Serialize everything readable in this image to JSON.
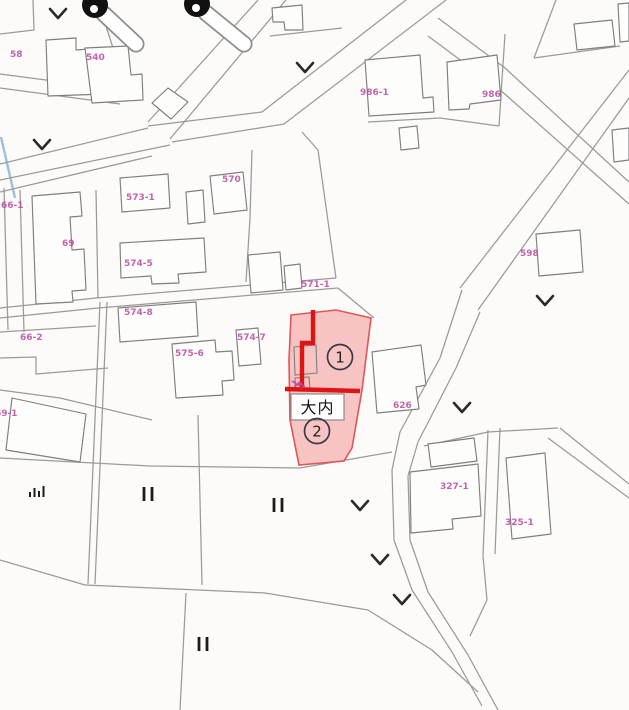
{
  "map": {
    "width": 629,
    "height": 710,
    "style": {
      "bg": "#fcfbf9",
      "road": "#9a9a9a",
      "building": "#7f7f7f",
      "building_fill": "#fdfdfc",
      "label_color": "#b94a9e",
      "symbol_color": "#2a2a2a",
      "water_line": "#8ab4d8"
    },
    "roads": [
      [
        [
          0,
          74
        ],
        [
          122,
          90
        ]
      ],
      [
        [
          0,
          88
        ],
        [
          120,
          104
        ]
      ],
      [
        [
          122,
          90
        ],
        [
          113,
          48
        ],
        [
          106,
          26
        ]
      ],
      [
        [
          258,
          0
        ],
        [
          148,
          122
        ]
      ],
      [
        [
          286,
          0
        ],
        [
          170,
          139
        ]
      ],
      [
        [
          148,
          128
        ],
        [
          0,
          164
        ]
      ],
      [
        [
          170,
          145
        ],
        [
          0,
          180
        ]
      ],
      [
        [
          0,
          192
        ],
        [
          152,
          156
        ]
      ],
      [
        [
          406,
          0
        ],
        [
          262,
          112
        ]
      ],
      [
        [
          446,
          0
        ],
        [
          284,
          124
        ]
      ],
      [
        [
          262,
          112
        ],
        [
          148,
          126
        ]
      ],
      [
        [
          284,
          124
        ],
        [
          172,
          142
        ]
      ],
      [
        [
          438,
          18
        ],
        [
          505,
          68
        ],
        [
          629,
          182
        ]
      ],
      [
        [
          428,
          36
        ],
        [
          498,
          88
        ],
        [
          629,
          204
        ]
      ],
      [
        [
          629,
          70
        ],
        [
          460,
          288
        ]
      ],
      [
        [
          629,
          98
        ],
        [
          478,
          310
        ]
      ],
      [
        [
          462,
          290
        ],
        [
          440,
          358
        ],
        [
          400,
          432
        ]
      ],
      [
        [
          480,
          312
        ],
        [
          456,
          368
        ],
        [
          418,
          442
        ]
      ],
      [
        [
          400,
          432
        ],
        [
          392,
          470
        ],
        [
          394,
          540
        ],
        [
          412,
          590
        ],
        [
          452,
          652
        ],
        [
          482,
          706
        ]
      ],
      [
        [
          418,
          442
        ],
        [
          408,
          476
        ],
        [
          410,
          540
        ],
        [
          428,
          592
        ],
        [
          468,
          655
        ],
        [
          498,
          710
        ]
      ],
      [
        [
          0,
          458
        ],
        [
          150,
          466
        ],
        [
          300,
          468
        ],
        [
          392,
          452
        ]
      ],
      [
        [
          424,
          446
        ],
        [
          488,
          432
        ],
        [
          558,
          428
        ]
      ],
      [
        [
          488,
          430
        ],
        [
          483,
          556
        ]
      ],
      [
        [
          500,
          428
        ],
        [
          495,
          554
        ]
      ],
      [
        [
          483,
          556
        ],
        [
          487,
          600
        ],
        [
          470,
          636
        ]
      ],
      [
        [
          548,
          438
        ],
        [
          629,
          498
        ]
      ],
      [
        [
          560,
          428
        ],
        [
          629,
          484
        ]
      ],
      [
        [
          85,
          585
        ],
        [
          265,
          593
        ],
        [
          368,
          610
        ],
        [
          432,
          650
        ],
        [
          478,
          692
        ]
      ],
      [
        [
          186,
          593
        ],
        [
          180,
          710
        ]
      ],
      [
        [
          0,
          560
        ],
        [
          85,
          585
        ]
      ],
      [
        [
          100,
          302
        ],
        [
          88,
          584
        ]
      ],
      [
        [
          107,
          302
        ],
        [
          95,
          584
        ]
      ],
      [
        [
          0,
          308
        ],
        [
          96,
          298
        ],
        [
          336,
          278
        ]
      ],
      [
        [
          0,
          318
        ],
        [
          98,
          308
        ],
        [
          338,
          288
        ]
      ],
      [
        [
          338,
          288
        ],
        [
          374,
          318
        ]
      ],
      [
        [
          336,
          278
        ],
        [
          318,
          150
        ],
        [
          302,
          132
        ]
      ],
      [
        [
          252,
          150
        ],
        [
          250,
          218
        ],
        [
          246,
          282
        ]
      ],
      [
        [
          4,
          188
        ],
        [
          8,
          330
        ]
      ],
      [
        [
          20,
          190
        ],
        [
          24,
          332
        ]
      ],
      [
        [
          96,
          190
        ],
        [
          98,
          298
        ]
      ],
      [
        [
          0,
          332
        ],
        [
          96,
          326
        ]
      ],
      [
        [
          0,
          358
        ],
        [
          36,
          357
        ],
        [
          36,
          374
        ],
        [
          108,
          368
        ]
      ],
      [
        [
          0,
          390
        ],
        [
          60,
          398
        ],
        [
          152,
          420
        ]
      ],
      [
        [
          505,
          34
        ],
        [
          499,
          126
        ]
      ],
      [
        [
          368,
          122
        ],
        [
          440,
          118
        ],
        [
          499,
          126
        ]
      ],
      [
        [
          556,
          0
        ],
        [
          534,
          58
        ]
      ],
      [
        [
          534,
          58
        ],
        [
          620,
          46
        ]
      ],
      [
        [
          270,
          36
        ],
        [
          342,
          28
        ]
      ],
      [
        [
          33,
          0
        ],
        [
          34,
          30
        ],
        [
          0,
          34
        ]
      ],
      [
        [
          198,
          415
        ],
        [
          202,
          585
        ]
      ]
    ],
    "buildings": [
      [
        [
          46,
          40
        ],
        [
          76,
          38
        ],
        [
          76,
          50
        ],
        [
          103,
          48
        ],
        [
          105,
          94
        ],
        [
          48,
          96
        ]
      ],
      [
        [
          85,
          48
        ],
        [
          128,
          46
        ],
        [
          131,
          75
        ],
        [
          142,
          74
        ],
        [
          143,
          100
        ],
        [
          92,
          103
        ]
      ],
      [
        [
          152,
          103
        ],
        [
          168,
          88
        ],
        [
          188,
          102
        ],
        [
          171,
          119
        ]
      ],
      [
        [
          365,
          60
        ],
        [
          420,
          55
        ],
        [
          423,
          98
        ],
        [
          433,
          97
        ],
        [
          434,
          112
        ],
        [
          369,
          116
        ]
      ],
      [
        [
          447,
          62
        ],
        [
          497,
          55
        ],
        [
          501,
          100
        ],
        [
          470,
          104
        ],
        [
          469,
          109
        ],
        [
          449,
          110
        ]
      ],
      [
        [
          399,
          128
        ],
        [
          417,
          126
        ],
        [
          419,
          148
        ],
        [
          401,
          150
        ]
      ],
      [
        [
          574,
          24
        ],
        [
          612,
          20
        ],
        [
          615,
          46
        ],
        [
          577,
          50
        ]
      ],
      [
        [
          618,
          4
        ],
        [
          629,
          3
        ],
        [
          629,
          41
        ],
        [
          620,
          42
        ]
      ],
      [
        [
          272,
          8
        ],
        [
          302,
          5
        ],
        [
          303,
          30
        ],
        [
          285,
          30
        ],
        [
          284,
          22
        ],
        [
          273,
          22
        ]
      ],
      [
        [
          120,
          178
        ],
        [
          168,
          174
        ],
        [
          170,
          208
        ],
        [
          122,
          212
        ]
      ],
      [
        [
          186,
          192
        ],
        [
          203,
          190
        ],
        [
          205,
          222
        ],
        [
          188,
          224
        ]
      ],
      [
        [
          210,
          176
        ],
        [
          243,
          172
        ],
        [
          247,
          210
        ],
        [
          214,
          214
        ]
      ],
      [
        [
          32,
          196
        ],
        [
          80,
          192
        ],
        [
          82,
          216
        ],
        [
          70,
          217
        ],
        [
          72,
          250
        ],
        [
          84,
          249
        ],
        [
          86,
          290
        ],
        [
          72,
          291
        ],
        [
          73,
          302
        ],
        [
          36,
          304
        ]
      ],
      [
        [
          120,
          243
        ],
        [
          204,
          238
        ],
        [
          206,
          272
        ],
        [
          178,
          274
        ],
        [
          179,
          283
        ],
        [
          152,
          284
        ],
        [
          151,
          276
        ],
        [
          121,
          278
        ]
      ],
      [
        [
          248,
          255
        ],
        [
          280,
          252
        ],
        [
          283,
          290
        ],
        [
          251,
          293
        ]
      ],
      [
        [
          284,
          266
        ],
        [
          300,
          264
        ],
        [
          302,
          288
        ],
        [
          286,
          290
        ]
      ],
      [
        [
          118,
          308
        ],
        [
          196,
          302
        ],
        [
          198,
          336
        ],
        [
          120,
          342
        ]
      ],
      [
        [
          172,
          344
        ],
        [
          215,
          340
        ],
        [
          216,
          352
        ],
        [
          232,
          351
        ],
        [
          234,
          380
        ],
        [
          222,
          381
        ],
        [
          223,
          395
        ],
        [
          176,
          398
        ]
      ],
      [
        [
          236,
          330
        ],
        [
          258,
          328
        ],
        [
          261,
          364
        ],
        [
          239,
          366
        ]
      ],
      [
        [
          372,
          352
        ],
        [
          421,
          345
        ],
        [
          426,
          385
        ],
        [
          416,
          387
        ],
        [
          419,
          409
        ],
        [
          377,
          413
        ]
      ],
      [
        [
          428,
          444
        ],
        [
          474,
          438
        ],
        [
          477,
          461
        ],
        [
          431,
          467
        ]
      ],
      [
        [
          410,
          472
        ],
        [
          478,
          464
        ],
        [
          481,
          516
        ],
        [
          452,
          519
        ],
        [
          453,
          529
        ],
        [
          411,
          533
        ]
      ],
      [
        [
          506,
          458
        ],
        [
          545,
          453
        ],
        [
          551,
          534
        ],
        [
          512,
          539
        ]
      ],
      [
        [
          12,
          398
        ],
        [
          86,
          414
        ],
        [
          80,
          462
        ],
        [
          6,
          450
        ]
      ],
      [
        [
          536,
          234
        ],
        [
          580,
          230
        ],
        [
          583,
          272
        ],
        [
          539,
          276
        ]
      ],
      [
        [
          612,
          130
        ],
        [
          629,
          128
        ],
        [
          629,
          160
        ],
        [
          614,
          162
        ]
      ]
    ],
    "parcel_labels": [
      {
        "text": "58",
        "x": 10,
        "y": 57
      },
      {
        "text": "540",
        "x": 86,
        "y": 60
      },
      {
        "text": "986-1",
        "x": 360,
        "y": 95
      },
      {
        "text": "986",
        "x": 482,
        "y": 97
      },
      {
        "text": "570",
        "x": 222,
        "y": 182
      },
      {
        "text": "573-1",
        "x": 126,
        "y": 200
      },
      {
        "text": "66-1",
        "x": 1,
        "y": 208
      },
      {
        "text": "69",
        "x": 62,
        "y": 246
      },
      {
        "text": "598",
        "x": 520,
        "y": 256
      },
      {
        "text": "574-5",
        "x": 124,
        "y": 266
      },
      {
        "text": "571-1",
        "x": 301,
        "y": 287
      },
      {
        "text": "574-8",
        "x": 124,
        "y": 315
      },
      {
        "text": "66-2",
        "x": 20,
        "y": 340
      },
      {
        "text": "574-7",
        "x": 237,
        "y": 340
      },
      {
        "text": "575-6",
        "x": 175,
        "y": 356
      },
      {
        "text": "69-1",
        "x": -5,
        "y": 416
      },
      {
        "text": "626",
        "x": 393,
        "y": 408
      },
      {
        "text": "327-1",
        "x": 440,
        "y": 489
      },
      {
        "text": "325-1",
        "x": 505,
        "y": 525
      }
    ],
    "highlight": {
      "fill": "#f4a2a2",
      "fill_opacity": 0.62,
      "border": "#e05555",
      "line": "#dd1414",
      "polygon": [
        [
          291,
          315
        ],
        [
          336,
          310
        ],
        [
          371,
          318
        ],
        [
          362,
          390
        ],
        [
          352,
          448
        ],
        [
          344,
          461
        ],
        [
          299,
          465
        ],
        [
          290,
          420
        ],
        [
          289,
          360
        ]
      ],
      "thick_lines": [
        [
          [
            313,
            310
          ],
          [
            313,
            343
          ],
          [
            302,
            343
          ],
          [
            302,
            387
          ]
        ],
        [
          [
            285,
            389
          ],
          [
            360,
            391
          ]
        ]
      ],
      "inner_buildings": [
        [
          [
            294,
            347
          ],
          [
            316,
            345
          ],
          [
            317,
            373
          ],
          [
            295,
            375
          ]
        ],
        [
          [
            295,
            378
          ],
          [
            309,
            377
          ],
          [
            310,
            390
          ],
          [
            296,
            391
          ]
        ]
      ],
      "circled_numbers": [
        {
          "n": "1",
          "x": 340,
          "y": 357
        },
        {
          "n": "2",
          "x": 317,
          "y": 431
        }
      ],
      "name": "大内",
      "name_box": {
        "x": 291,
        "y": 394,
        "w": 53,
        "h": 26
      }
    },
    "symbols": {
      "chevrons": [
        [
          58,
          14
        ],
        [
          305,
          68
        ],
        [
          42,
          145
        ],
        [
          545,
          301
        ],
        [
          462,
          408
        ],
        [
          360,
          506
        ],
        [
          380,
          560
        ],
        [
          402,
          600
        ]
      ],
      "paddy_marks": [
        [
          148,
          494
        ],
        [
          278,
          505
        ],
        [
          203,
          644
        ]
      ],
      "bar_mark": {
        "x": 30,
        "y": 497,
        "heights": [
          5,
          9,
          6,
          11
        ]
      },
      "pins": [
        {
          "cx": 95,
          "cy": 5,
          "bx1": 104,
          "by1": 14,
          "bx2": 136,
          "by2": 44
        },
        {
          "cx": 197,
          "cy": 4,
          "bx1": 206,
          "by1": 13,
          "bx2": 244,
          "by2": 44
        }
      ],
      "scribble": [
        [
          [
            292,
            381
          ],
          [
            300,
            386
          ]
        ],
        [
          [
            294,
            386
          ],
          [
            302,
            383
          ]
        ],
        [
          [
            298,
            382
          ],
          [
            305,
            387
          ]
        ]
      ],
      "water_line": [
        [
          1,
          137
        ],
        [
          15,
          198
        ]
      ]
    }
  }
}
